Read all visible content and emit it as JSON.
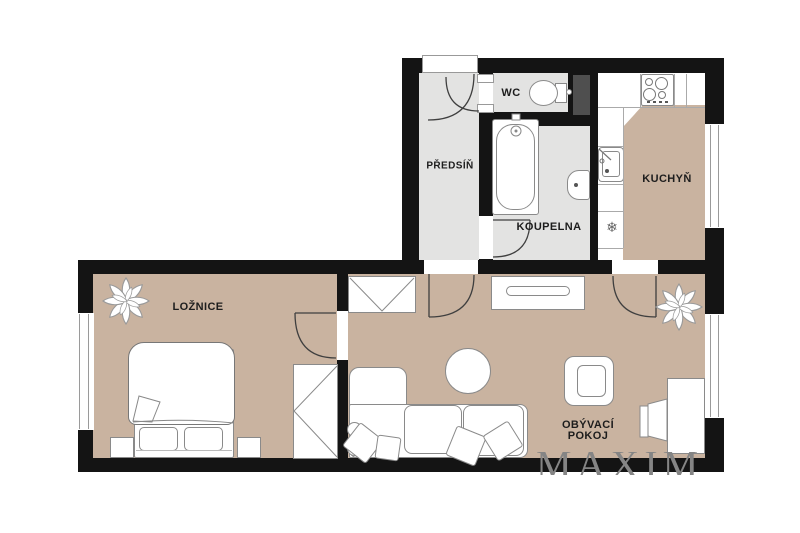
{
  "floorplan": {
    "watermark": "MAXIM",
    "rooms": {
      "hallway": {
        "label": "PŘEDSÍŇ"
      },
      "wc": {
        "label": "WC"
      },
      "bathroom": {
        "label": "KOUPELNA"
      },
      "kitchen": {
        "label": "KUCHYŇ"
      },
      "bedroom": {
        "label": "LOŽNICE"
      },
      "living_room": {
        "label_line1": "OBÝVACÍ",
        "label_line2": "POKOJ"
      }
    },
    "icons": {
      "fridge_snowflake": "❄"
    },
    "colors": {
      "wall": "#141414",
      "floor_warm": "#c9b3a0",
      "floor_tile": "#e3e3e2",
      "shaft": "#4f4f4f",
      "furniture_outline": "#8a8a8a",
      "watermark": "#858585",
      "background": "#ffffff"
    }
  }
}
